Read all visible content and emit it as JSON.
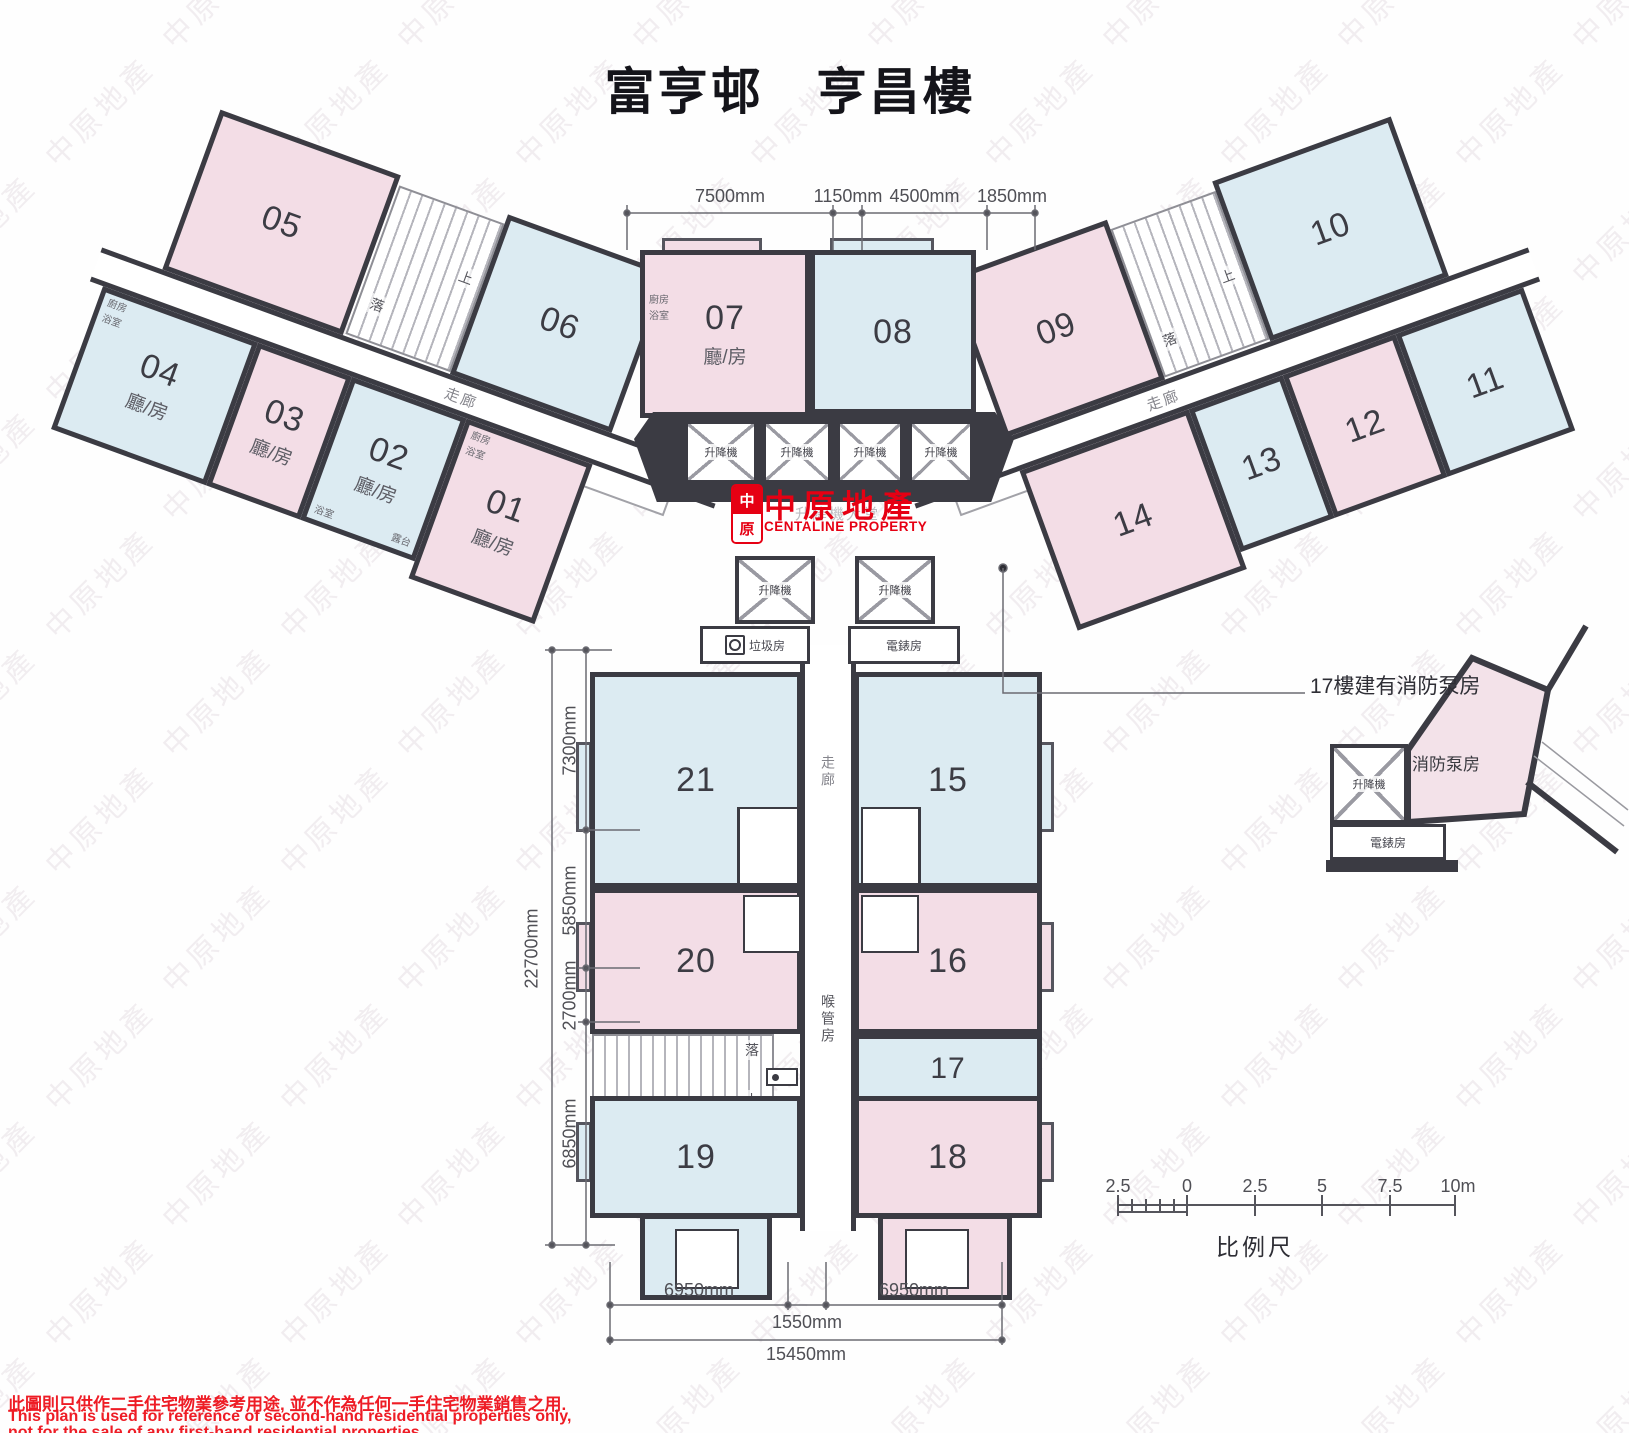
{
  "title": "富亨邨　亨昌樓",
  "watermark": {
    "text": "中原地產"
  },
  "logo": {
    "mark_top": "中",
    "mark_bottom": "原",
    "name_cn": "中原地產",
    "name_en": "CENTALINE PROPERTY"
  },
  "labels": {
    "corridor": "走廊",
    "lift": "升降機",
    "lift_lobby": "升降機大堂",
    "refuse_room": "垃圾房",
    "meter_room": "電錶房",
    "pipe_duct_room": "喉管房",
    "fire_pump_room": "消防泵房",
    "stair_up": "上",
    "stair_down": "落",
    "living_room": "廳/房",
    "kitchen": "廚房",
    "bathroom": "浴室",
    "balcony": "露台"
  },
  "notes": {
    "fire_pump": "17樓建有消防泵房"
  },
  "units": [
    {
      "no": "01",
      "type": "pink"
    },
    {
      "no": "02",
      "type": "blue"
    },
    {
      "no": "03",
      "type": "pink"
    },
    {
      "no": "04",
      "type": "blue"
    },
    {
      "no": "05",
      "type": "pink"
    },
    {
      "no": "06",
      "type": "blue"
    },
    {
      "no": "07",
      "type": "pink"
    },
    {
      "no": "08",
      "type": "blue"
    },
    {
      "no": "09",
      "type": "pink"
    },
    {
      "no": "10",
      "type": "blue"
    },
    {
      "no": "11",
      "type": "blue"
    },
    {
      "no": "12",
      "type": "pink"
    },
    {
      "no": "13",
      "type": "blue"
    },
    {
      "no": "14",
      "type": "pink"
    },
    {
      "no": "15",
      "type": "blue"
    },
    {
      "no": "16",
      "type": "pink"
    },
    {
      "no": "17",
      "type": "blue"
    },
    {
      "no": "18",
      "type": "pink"
    },
    {
      "no": "19",
      "type": "blue"
    },
    {
      "no": "20",
      "type": "pink"
    },
    {
      "no": "21",
      "type": "blue"
    }
  ],
  "dimensions": {
    "top": [
      "7500mm",
      "1150mm",
      "4500mm",
      "1850mm"
    ],
    "left": [
      "7300mm",
      "5850mm",
      "2700mm",
      "6850mm"
    ],
    "left_total": "22700mm",
    "bottom": [
      "6950mm",
      "1550mm",
      "6950mm"
    ],
    "bottom_total": "15450mm"
  },
  "scale_bar": {
    "ticks": [
      "2.5",
      "0",
      "2.5",
      "5",
      "7.5",
      "10m"
    ],
    "label": "比例尺"
  },
  "disclaimer": {
    "zh": "此圖則只供作二手住宅物業參考用途, 並不作為任何一手住宅物業銷售之用.",
    "en1": "This plan is used for reference of second-hand residential properties only,",
    "en2": "not for the sale of any first-hand residential properties."
  },
  "colors": {
    "unit_pink": "#f3dde6",
    "unit_blue": "#dcebf2",
    "wall": "#3b3b43",
    "brand_red": "#e60013",
    "disclaimer_red": "#ee1c25"
  }
}
